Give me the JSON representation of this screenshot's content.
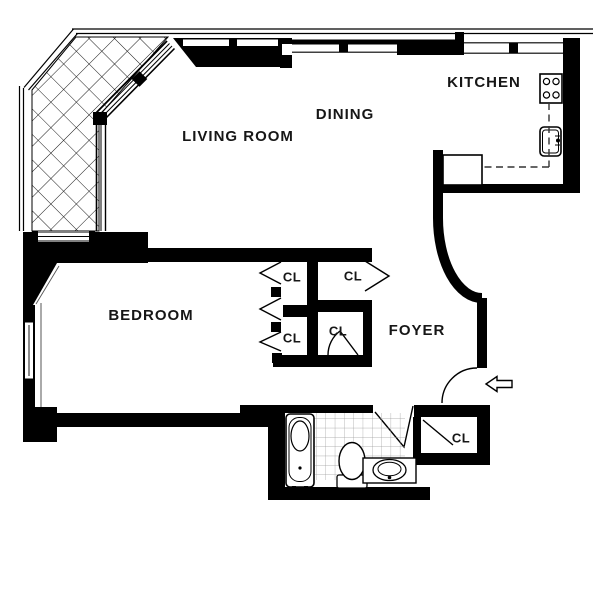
{
  "title": "Apartment floor plan",
  "canvas": {
    "width": 600,
    "height": 600,
    "background": "#ffffff",
    "wall_color": "#000000",
    "line_color": "#1a1a1a",
    "tile_line_color": "#9a9a9a",
    "label_color": "#161616"
  },
  "labels": {
    "living_room": "LIVING ROOM",
    "dining": "DINING",
    "kitchen": "KITCHEN",
    "bedroom": "BEDROOM",
    "foyer": "FOYER",
    "closet": "CL"
  },
  "closet_count": 5,
  "icons": [
    {
      "name": "stove-icon",
      "location": "kitchen"
    },
    {
      "name": "kitchen-sink-icon",
      "location": "kitchen"
    },
    {
      "name": "counter-dashed-outline",
      "location": "kitchen"
    },
    {
      "name": "refrigerator-counter-icon",
      "location": "kitchen"
    },
    {
      "name": "bathtub-icon",
      "location": "bathroom"
    },
    {
      "name": "toilet-icon",
      "location": "bathroom"
    },
    {
      "name": "vanity-sink-icon",
      "location": "bathroom"
    },
    {
      "name": "tiled-floor-pattern",
      "location": "bathroom"
    },
    {
      "name": "entry-arrow-icon",
      "location": "foyer-entry",
      "direction": "left"
    },
    {
      "name": "terrace-glazing-crosshatch",
      "location": "terrace"
    },
    {
      "name": "bifold-door-icon",
      "count": 4
    },
    {
      "name": "swing-door-icon",
      "count": 4
    }
  ]
}
